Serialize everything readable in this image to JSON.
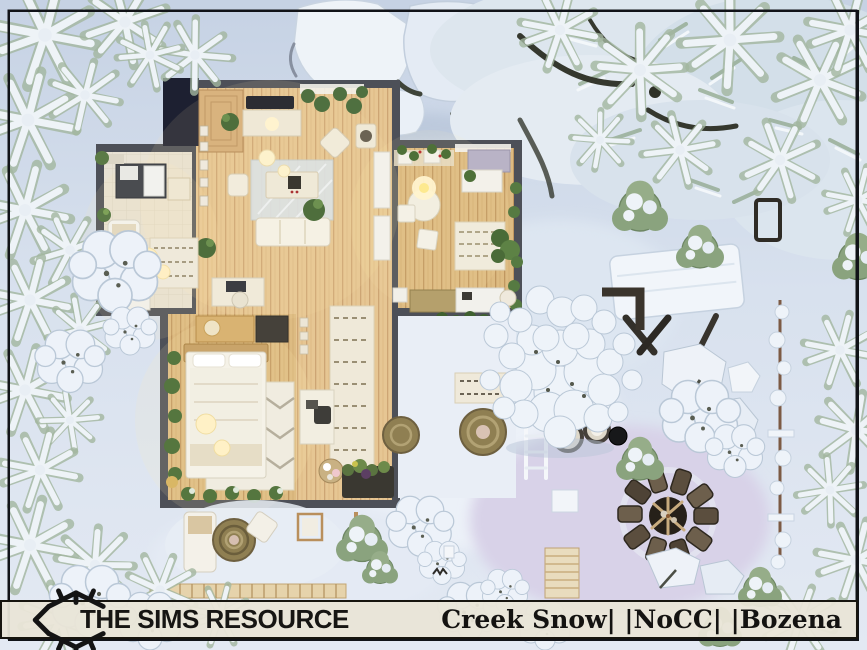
{
  "banner": {
    "brand": "THE SIMS RESOURCE",
    "title": "Creek Snow| |NoCC| |Bozena"
  },
  "logo": {
    "icon": "tsr-diamond-crest"
  },
  "palette": {
    "banner_bg": "#e9e5d7",
    "banner_border": "#17150f",
    "banner_text": "#161513",
    "wall": "#4d5058",
    "flat_roof": "#1d2031",
    "wood_floor": "#e6c693",
    "wood_floor_dark": "#ddbb82",
    "tile_floor": "#e8e2d4",
    "snow": "#d8e1ee",
    "snow_bright": "#eef3f9",
    "snow_lavender": "#d8d2e8",
    "evergreen": "#8fa78c",
    "indoor_plant": "#4e7038",
    "rug_olive": "#8f7f52",
    "firepit_rock": "#5b4e3e",
    "accent_wood": "#c9a46a"
  }
}
